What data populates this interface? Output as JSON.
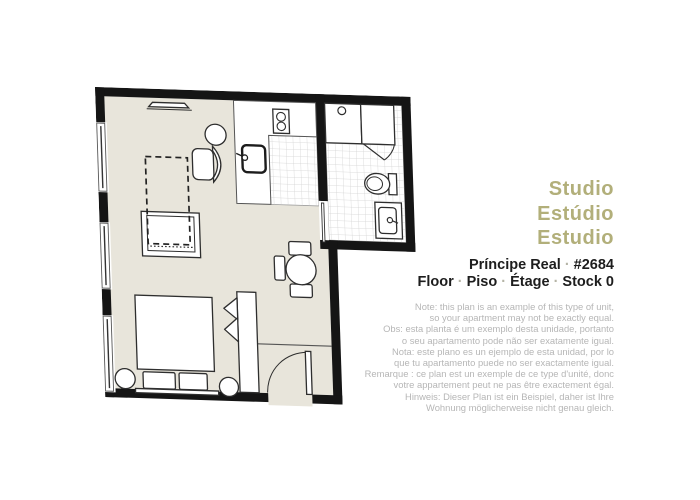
{
  "colors": {
    "accent": "#b2af7a",
    "separator": "#b5b4a6",
    "text": "#1d1d1d",
    "note": "#b6b6b6",
    "wall": "#151515",
    "floor": "#e8e5db",
    "outline": "#2e2e2e",
    "tile_line": "#cfcfcf"
  },
  "title": {
    "lines": [
      "Studio",
      "Estúdio",
      "Estudio"
    ]
  },
  "info": {
    "separator": "·",
    "line1": [
      "Príncipe Real",
      "#2684"
    ],
    "line2": [
      "Floor",
      "Piso",
      "Étage",
      "Stock 0"
    ]
  },
  "note": {
    "lines": [
      "Note: this plan is an example of this type of unit,",
      "so your apartment may not be exactly equal.",
      "Obs: esta planta é um exemplo desta unidade, portanto",
      "o seu apartamento pode não ser exatamente igual.",
      "Nota: este plano es un ejemplo de esta unidad, por lo",
      "que tu apartamento puede no ser exactamente igual.",
      "Remarque : ce plan est un exemple de ce type d'unité, donc",
      "votre appartement peut ne pas être exactement égal.",
      "Hinweis: Dieser Plan ist ein Beispiel, daher ist Ihre",
      "Wohnung möglicherweise nicht genau gleich."
    ]
  },
  "floorplan": {
    "rooms": [
      "main-room",
      "kitchen",
      "bathroom",
      "entry"
    ],
    "furniture": [
      "bed",
      "pillows",
      "nightstand-left",
      "nightstand-right",
      "wardrobe",
      "sofa",
      "armchair",
      "round-side-table",
      "dining-table",
      "dining-chairs",
      "kitchen-counter",
      "stove",
      "kitchen-sink",
      "shower",
      "shower-panel",
      "toilet",
      "bathroom-vanity",
      "entrance-door",
      "sliding-door",
      "windows",
      "wall-radiator",
      "dashed-ceiling-outline"
    ]
  }
}
